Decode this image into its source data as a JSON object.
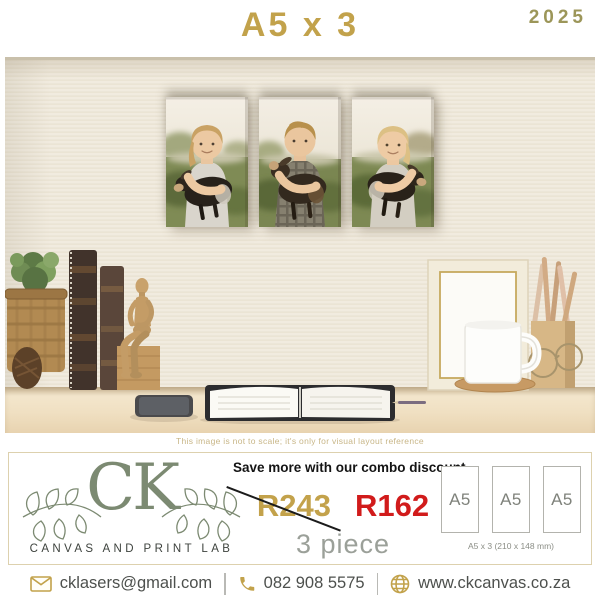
{
  "header": {
    "title": "A5 x 3",
    "year": "2025"
  },
  "photo": {
    "disclaimer": "This image is not to scale; it's only for visual layout reference",
    "canvas_count": "3"
  },
  "brand": {
    "monogram": "CK",
    "tagline": "CANVAS AND PRINT LAB"
  },
  "offer": {
    "headline": "Save more with our combo discount",
    "old_price": "R243",
    "new_price": "R162",
    "quantity": "3 piece"
  },
  "sizes": {
    "labels": [
      "A5",
      "A5",
      "A5"
    ],
    "caption": "A5 x 3  (210 x 148 mm)"
  },
  "footer": {
    "items": [
      {
        "icon": "envelope-icon",
        "text": "cklasers@gmail.com"
      },
      {
        "icon": "phone-icon",
        "text": "082 908 5575"
      },
      {
        "icon": "globe-icon",
        "text": "www.ckcanvas.co.za"
      }
    ]
  },
  "colors": {
    "accent_gold": "#c2a24b",
    "brand_sage": "#7c8a72",
    "price_red": "#d11b1b",
    "year_olive": "#9c9659"
  }
}
